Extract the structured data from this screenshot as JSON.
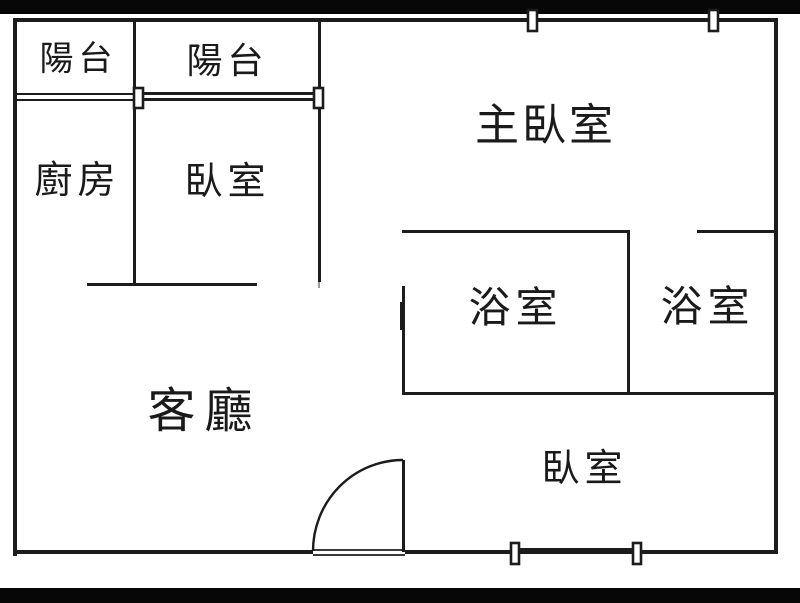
{
  "colors": {
    "wall": "#1c1c1c",
    "background": "#ffffff",
    "letterbox": "#070707",
    "text": "#1a1a1a"
  },
  "floor_plan": {
    "labels": {
      "balcony_left": "陽台",
      "balcony_main": "陽台",
      "kitchen": "廚房",
      "bedroom_top": "臥室",
      "master_bedroom": "主臥室",
      "bathroom_left": "浴室",
      "bathroom_right": "浴室",
      "living_room": "客廳",
      "bedroom_bottom": "臥室"
    }
  }
}
